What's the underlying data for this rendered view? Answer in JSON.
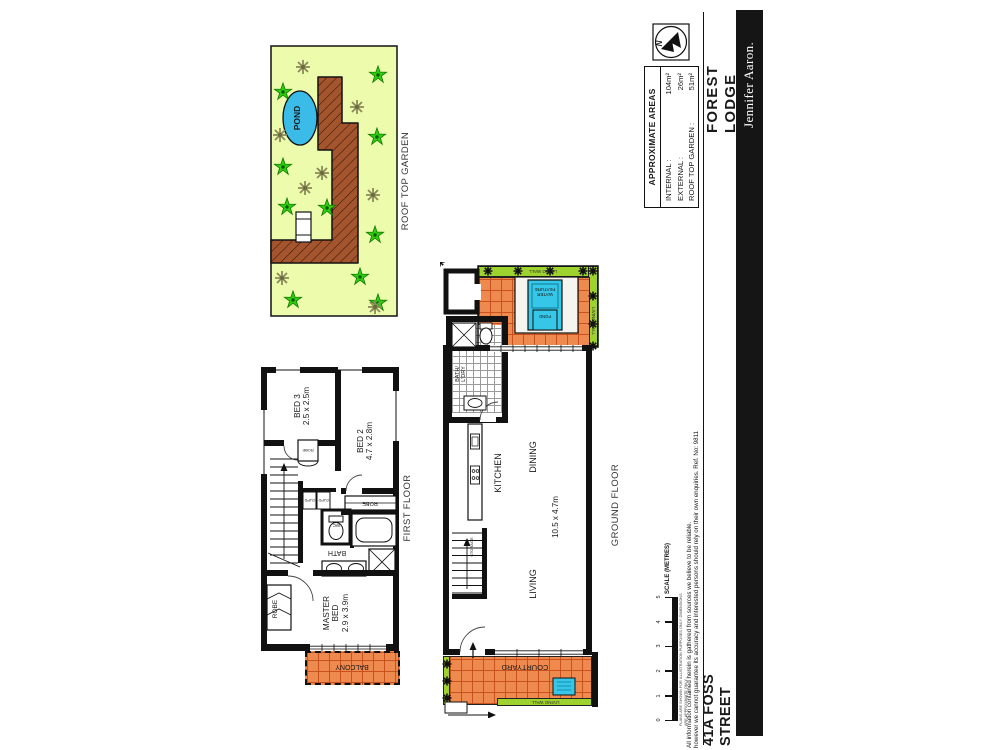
{
  "branding": {
    "suburb": "FOREST LODGE",
    "agency": "Jennifer Aaron.",
    "street": "41A FOSS STREET"
  },
  "compass": {
    "north": "N"
  },
  "areas": {
    "title": "APPROXIMATE AREAS",
    "rows": [
      {
        "label": "INTERNAL :",
        "value": "104m²"
      },
      {
        "label": "EXTERNAL :",
        "value": "26m²"
      },
      {
        "label": "ROOF TOP GARDEN :",
        "value": "51m²"
      }
    ]
  },
  "roof": {
    "label": "ROOF TOP GARDEN",
    "pond": "POND"
  },
  "first": {
    "label": "FIRST FLOOR",
    "bed3": "BED 3\n2.5 x 2.5m",
    "bed2": "BED 2\n4.7 x 2.8m",
    "master": "MASTER\nBED\n2.9 x 3.9m",
    "robe": "ROBE",
    "bath": "BATH",
    "wc": "WC",
    "cupd": "CUPD",
    "balcony": "BALCONY"
  },
  "ground": {
    "label": "GROUND FLOOR",
    "kitchen": "KITCHEN",
    "dining": "DINING",
    "living": "LIVING",
    "living_dim": "10.5 x 4.7m",
    "bath_ldry": "BATH/\nL'DRY",
    "storage": "STORAGE",
    "courtyard": "COURTYARD",
    "living_wall": "LIVING WALL",
    "water_feature": "WATER\nFEATURE",
    "pond": "POND"
  },
  "scale": {
    "label": "SCALE (METRES)",
    "ticks": [
      "0",
      "1",
      "2",
      "3",
      "4",
      "5"
    ]
  },
  "fineprint": {
    "micro": "PLANS ARE SHOWN FOR ILLUSTRATION PURPOSES ONLY. DIMENSIONS ARE APPROXIMATE ONLY.",
    "line1": "All information contained herein is gathered from sources we believe to be reliable.",
    "line2": "however we cannot guarantee its accuracy and interested persons should rely on their own enquiries. Ref. No: 9811"
  },
  "colors": {
    "tile_orange": "#ef8a4e",
    "tile_grid": "#c8511f",
    "living_wall_green": "#9ed22f",
    "water_cyan": "#35c6e8",
    "garden_bg": "#ecfbac",
    "path_brown": "#a5552d",
    "plant_green": "#2fcc0f",
    "plant_olive": "#8a8a5a",
    "wall_black": "#111111",
    "agency_bar": "#151515"
  }
}
